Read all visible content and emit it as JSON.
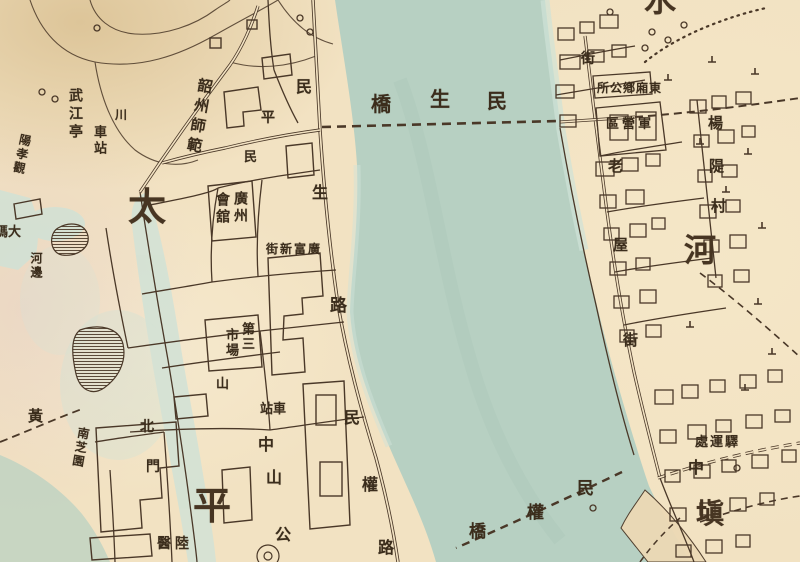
{
  "colors": {
    "paper": "#f2e2c2",
    "paper_dark": "#e6d0a6",
    "water": "#b7d0c2",
    "water_light": "#cfe2d7",
    "ink": "#4a3828",
    "text": "#3b2d1c"
  },
  "labels": {
    "district_tai": "太",
    "district_ping": "平",
    "district_shui": "水",
    "district_he": "河",
    "district_tian": "塡",
    "zhong_mid": "中",
    "minsheng_rd_1": "民",
    "minsheng_rd_2": "生",
    "minsheng_rd_3": "路",
    "minquan_rd_1": "民",
    "minquan_rd_2": "權",
    "minquan_rd_3": "路",
    "minsheng_bridge_1": "橋",
    "minsheng_bridge_2": "生",
    "minsheng_bridge_3": "民",
    "minquan_bridge_1": "民",
    "minquan_bridge_2": "權",
    "minquan_bridge_3": "橋",
    "laowu_st_1": "老",
    "laowu_st_2": "屋",
    "laowu_st_3": "街",
    "jie_ne": "街",
    "zhongshan_park_1": "中",
    "zhongshan_park_2": "山",
    "zhongshan_park_3": "公",
    "shan_frag": "山",
    "huang": "黃",
    "chuan": "川",
    "min_frag": "民",
    "ping_frag": "平",
    "wujiang_ting": "武江亭",
    "chezhan_west": "車站",
    "yangxiao_guan": "陽孝觀",
    "shaozhou_shifan": "韶州師範",
    "guild_col_right": "廣州",
    "guild_col_left": "會舘",
    "guangfu_new_street": "街新富廣",
    "market_col_right": "第三",
    "market_col_left": "市場",
    "dongxiang_office": "所公鄕廂東",
    "junying_qu": "區營軍",
    "yangdi_1": "楊",
    "yangdi_2": "隄",
    "yangdi_3": "村",
    "yiyun_chu": "處運驛",
    "beimen_1": "北",
    "beimen_2": "門",
    "lu_hospital": "醫陸",
    "nanzhi_garden": "南芝園",
    "dama_tou": "碼大",
    "hebian": "河邊",
    "chezhan_park": "站車"
  }
}
